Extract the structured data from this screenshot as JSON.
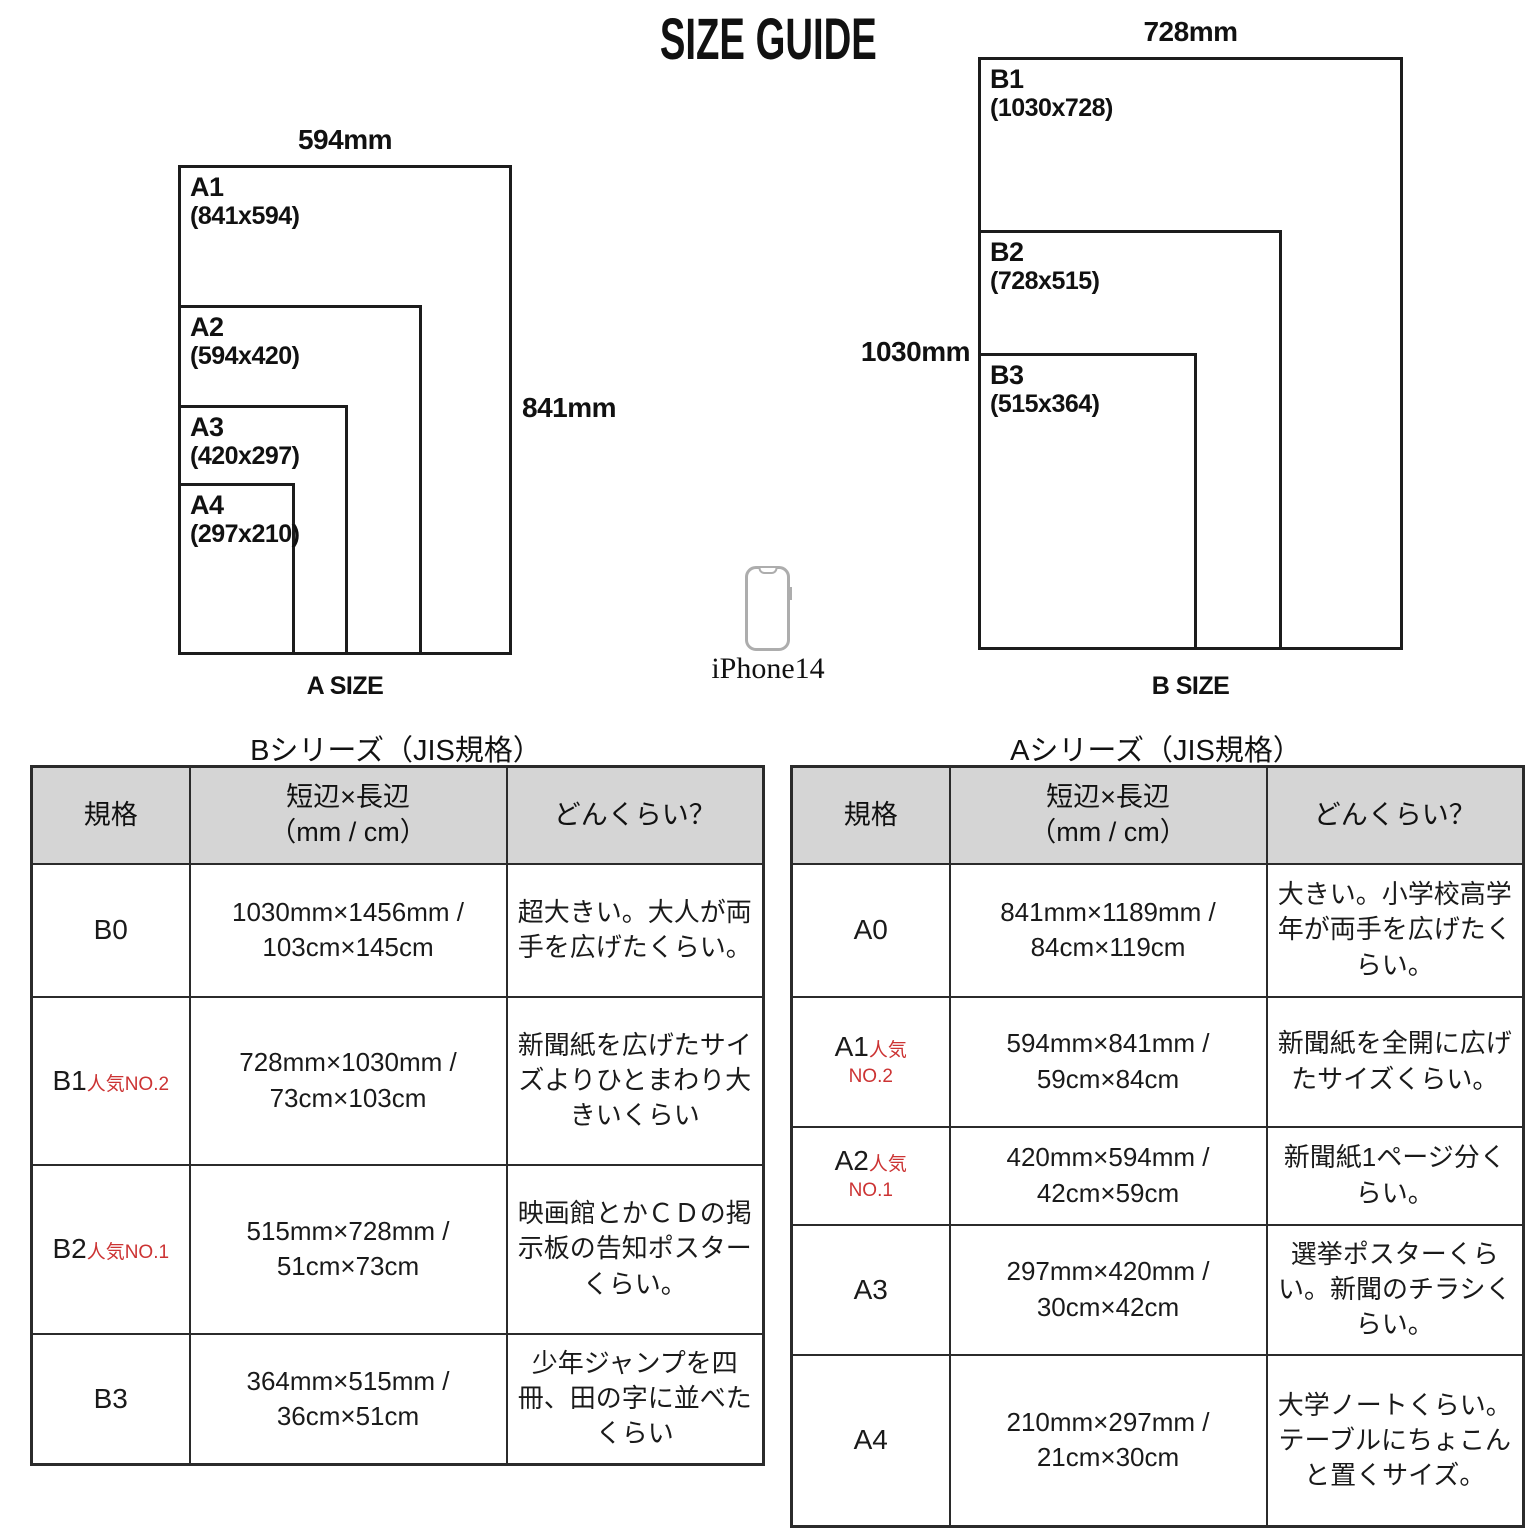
{
  "page": {
    "title": "SIZE GUIDE"
  },
  "colors": {
    "badge_red": "#cc3333",
    "header_bg": "#d5d5d5",
    "border": "#2b2b2b"
  },
  "diagrams": {
    "a": {
      "top_dimension": "594mm",
      "side_dimension": "841mm",
      "caption": "A SIZE",
      "sheets": [
        {
          "label": "A1",
          "dims": "(841x594)"
        },
        {
          "label": "A2",
          "dims": "(594x420)"
        },
        {
          "label": "A3",
          "dims": "(420x297)"
        },
        {
          "label": "A4",
          "dims": "(297x210)"
        }
      ]
    },
    "b": {
      "top_dimension": "728mm",
      "side_dimension": "1030mm",
      "caption": "B SIZE",
      "sheets": [
        {
          "label": "B1",
          "dims": "(1030x728)"
        },
        {
          "label": "B2",
          "dims": "(728x515)"
        },
        {
          "label": "B3",
          "dims": "(515x364)"
        }
      ]
    },
    "phone": {
      "icon": "iphone-outline",
      "label": "iPhone14"
    }
  },
  "tables": {
    "b": {
      "title": "Bシリーズ（JIS規格）",
      "headers": {
        "standard": "規格",
        "dims_line1": "短辺×長辺",
        "dims_line2": "（mm / cm）",
        "about": "どんくらい？"
      },
      "rows": [
        {
          "name": "B0",
          "badge_inline": "",
          "badge_below": "",
          "dims": "1030mm×1456mm / 103cm×145cm",
          "about": "超大きい。大人が両手を広げたくらい。"
        },
        {
          "name": "B1",
          "badge_inline": "人気NO.2",
          "badge_below": "",
          "dims": "728mm×1030mm / 73cm×103cm",
          "about": "新聞紙を広げたサイズよりひとまわり大きいくらい"
        },
        {
          "name": "B2",
          "badge_inline": "人気NO.1",
          "badge_below": "",
          "dims": "515mm×728mm / 51cm×73cm",
          "about": "映画館とかＣＤの掲示板の告知ポスターくらい。"
        },
        {
          "name": "B3",
          "badge_inline": "",
          "badge_below": "",
          "dims": "364mm×515mm / 36cm×51cm",
          "about": "少年ジャンプを四冊、田の字に並べたくらい"
        }
      ]
    },
    "a": {
      "title": "Aシリーズ（JIS規格）",
      "headers": {
        "standard": "規格",
        "dims_line1": "短辺×長辺",
        "dims_line2": "（mm / cm）",
        "about": "どんくらい？"
      },
      "rows": [
        {
          "name": "A0",
          "badge_inline": "",
          "badge_below": "",
          "dims": "841mm×1189mm / 84cm×119cm",
          "about": "大きい。小学校高学年が両手を広げたくらい。"
        },
        {
          "name": "A1",
          "badge_inline": "人気",
          "badge_below": "NO.2",
          "dims": "594mm×841mm / 59cm×84cm",
          "about": "新聞紙を全開に広げたサイズくらい。"
        },
        {
          "name": "A2",
          "badge_inline": "人気",
          "badge_below": "NO.1",
          "dims": "420mm×594mm / 42cm×59cm",
          "about": "新聞紙1ページ分くらい。"
        },
        {
          "name": "A3",
          "badge_inline": "",
          "badge_below": "",
          "dims": "297mm×420mm / 30cm×42cm",
          "about": "選挙ポスターくらい。新聞のチラシくらい。"
        },
        {
          "name": "A4",
          "badge_inline": "",
          "badge_below": "",
          "dims": "210mm×297mm / 21cm×30cm",
          "about": "大学ノートくらい。テーブルにちょこんと置くサイズ。"
        }
      ]
    }
  }
}
